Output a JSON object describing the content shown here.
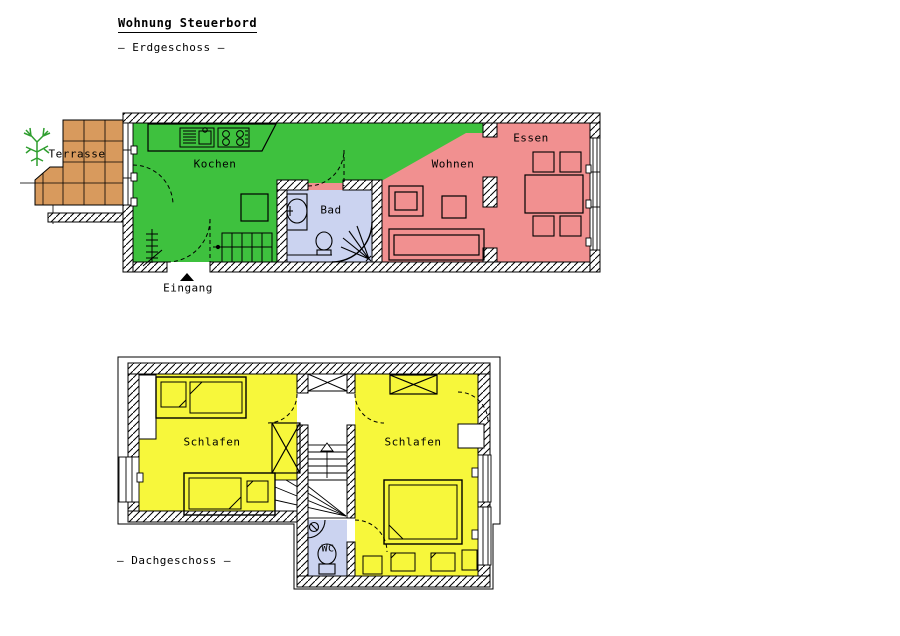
{
  "header": {
    "title": "Wohnung Steuerbord",
    "floor_ground": "– Erdgeschoss –",
    "floor_attic": "– Dachgeschoss –"
  },
  "ground_floor": {
    "rooms": {
      "terrasse": "Terrasse",
      "kochen": "Kochen",
      "bad": "Bad",
      "wohnen": "Wohnen",
      "essen": "Essen"
    },
    "entrance_label": "Eingang"
  },
  "attic_floor": {
    "rooms": {
      "schlafen_left": "Schlafen",
      "schlafen_right": "Schlafen",
      "wc": "WC"
    }
  },
  "colors": {
    "kitchen_green": "#3ec13e",
    "living_red": "#f19090",
    "bedroom_yellow": "#f7f73b",
    "bath_blue": "#cbd3f0",
    "terrace_tan": "#d89a5d",
    "tree_green": "#2f9e2f",
    "line_black": "#000000"
  }
}
